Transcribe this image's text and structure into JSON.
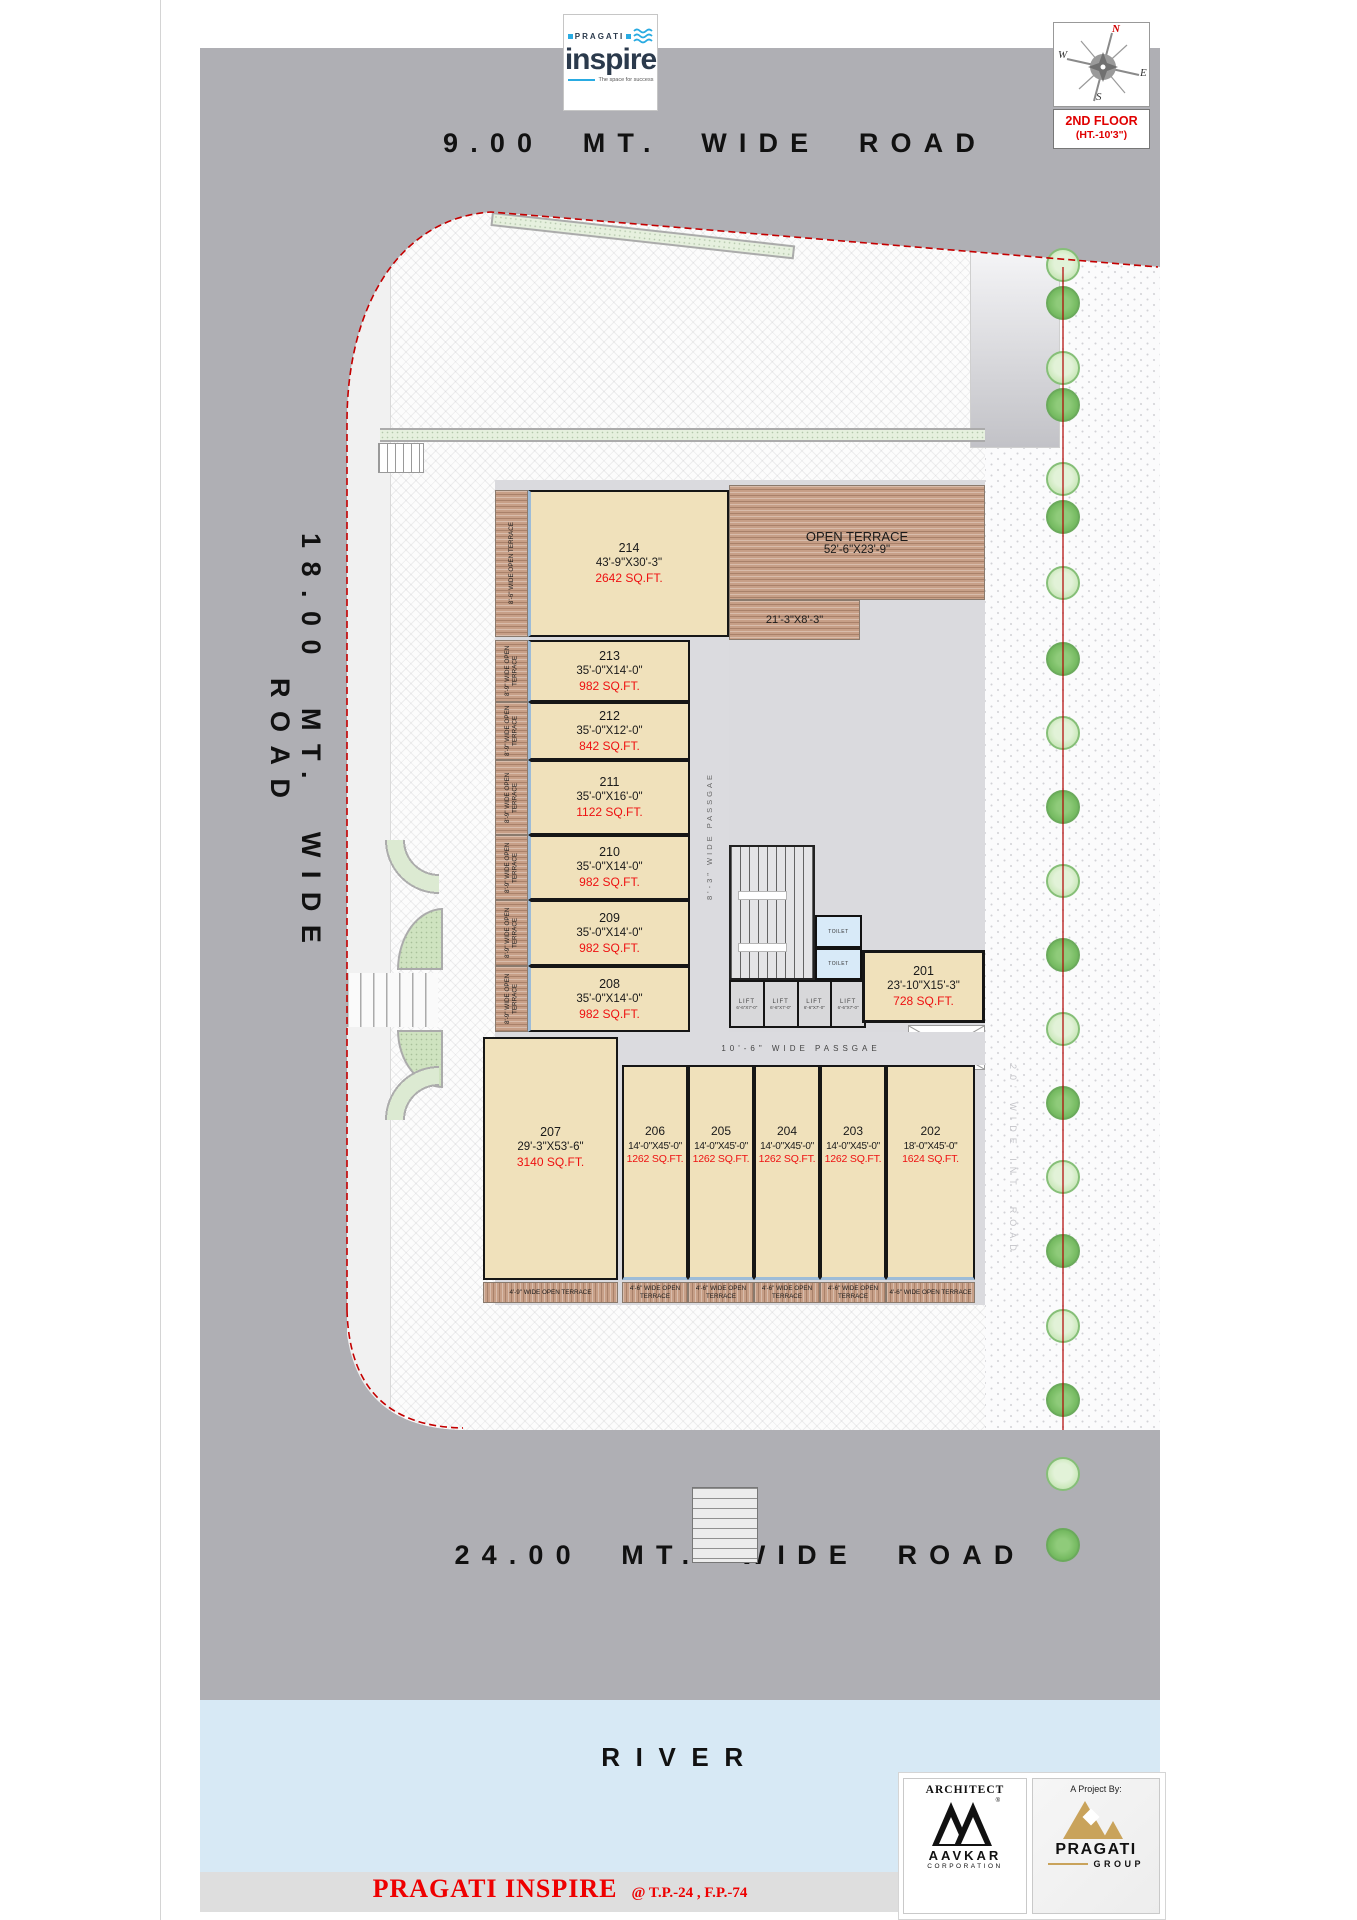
{
  "logo": {
    "brand": "PRAGATI",
    "name": "inspire",
    "tagline": "The space for success"
  },
  "compass": {
    "n": "N",
    "e": "E",
    "s": "S",
    "w": "W"
  },
  "floor_box": {
    "line1": "2ND FLOOR",
    "line2": "(HT.-10'3\")"
  },
  "roads": {
    "top": "9.00 MT. WIDE ROAD",
    "left": "18.00 MT. WIDE ROAD",
    "bottom": "24.00 MT. WIDE ROAD",
    "internal": "20' WIDE INT. ROAD",
    "river": "RIVER"
  },
  "plan": {
    "open_terrace": {
      "title": "OPEN TERRACE",
      "dim": "52'-6\"X23'-9\"",
      "sub_dim": "21'-3\"X8'-3\""
    },
    "passage_vertical": "8'-3\" WIDE PASSGAE",
    "passage_horizontal": "10'-6\" WIDE PASSGAE",
    "toilet_top": "TOILET",
    "toilet_bottom": "TOILET",
    "lift": {
      "label": "LIFT",
      "dim": "6'-6\"X7'-0\""
    },
    "units": [
      {
        "number": "214",
        "dim": "43'-9\"X30'-3\"",
        "area": "2642 SQ.FT.",
        "terrace": "8'-6\" WIDE OPEN TERRACE"
      },
      {
        "number": "213",
        "dim": "35'-0\"X14'-0\"",
        "area": "982 SQ.FT.",
        "terrace": "8'-9\" WIDE OPEN TERRACE"
      },
      {
        "number": "212",
        "dim": "35'-0\"X12'-0\"",
        "area": "842 SQ.FT.",
        "terrace": "8'-9\" WIDE OPEN TERRACE"
      },
      {
        "number": "211",
        "dim": "35'-0\"X16'-0\"",
        "area": "1122 SQ.FT.",
        "terrace": "8'-9\" WIDE OPEN TERRACE"
      },
      {
        "number": "210",
        "dim": "35'-0\"X14'-0\"",
        "area": "982 SQ.FT.",
        "terrace": "8'-9\" WIDE OPEN TERRACE"
      },
      {
        "number": "209",
        "dim": "35'-0\"X14'-0\"",
        "area": "982 SQ.FT.",
        "terrace": "8'-9\" WIDE OPEN TERRACE"
      },
      {
        "number": "208",
        "dim": "35'-0\"X14'-0\"",
        "area": "982 SQ.FT.",
        "terrace": "8'-9\" WIDE OPEN TERRACE"
      },
      {
        "number": "201",
        "dim": "23'-10\"X15'-3\"",
        "area": "728 SQ.FT."
      }
    ],
    "bottom_units": [
      {
        "number": "207",
        "dim": "29'-3\"X53'-6\"",
        "area": "3140 SQ.FT.",
        "terrace": "4'-9\" WIDE OPEN TERRACE"
      },
      {
        "number": "206",
        "dim": "14'-0\"X45'-0\"",
        "area": "1262 SQ.FT.",
        "terrace": "4'-6\" WIDE OPEN TERRACE"
      },
      {
        "number": "205",
        "dim": "14'-0\"X45'-0\"",
        "area": "1262 SQ.FT.",
        "terrace": "4'-6\" WIDE OPEN TERRACE"
      },
      {
        "number": "204",
        "dim": "14'-0\"X45'-0\"",
        "area": "1262 SQ.FT.",
        "terrace": "4'-6\" WIDE OPEN TERRACE"
      },
      {
        "number": "203",
        "dim": "14'-0\"X45'-0\"",
        "area": "1262 SQ.FT.",
        "terrace": "4'-6\" WIDE OPEN TERRACE"
      },
      {
        "number": "202",
        "dim": "18'-0\"X45'-0\"",
        "area": "1624 SQ.FT.",
        "terrace": "4'-6\" WIDE OPEN TERRACE"
      }
    ]
  },
  "footer": {
    "title": "PRAGATI INSPIRE",
    "ref": "@ T.P.-24 , F.P.-74",
    "architect": {
      "header": "ARCHITECT",
      "name": "AAVKAR",
      "sub": "CORPORATION"
    },
    "project": {
      "header": "A Project By:",
      "name": "PRAGATI",
      "sub": "GROUP"
    }
  },
  "colors": {
    "road": "#AFAFB4",
    "river": "#D7E9F5",
    "unit": "#F0E1BB",
    "wood": "#C79F87",
    "accent_red": "#E30613",
    "logo_blue": "#29ABE2",
    "logo_navy": "#2B3A4C",
    "gold": "#C9A35B"
  }
}
